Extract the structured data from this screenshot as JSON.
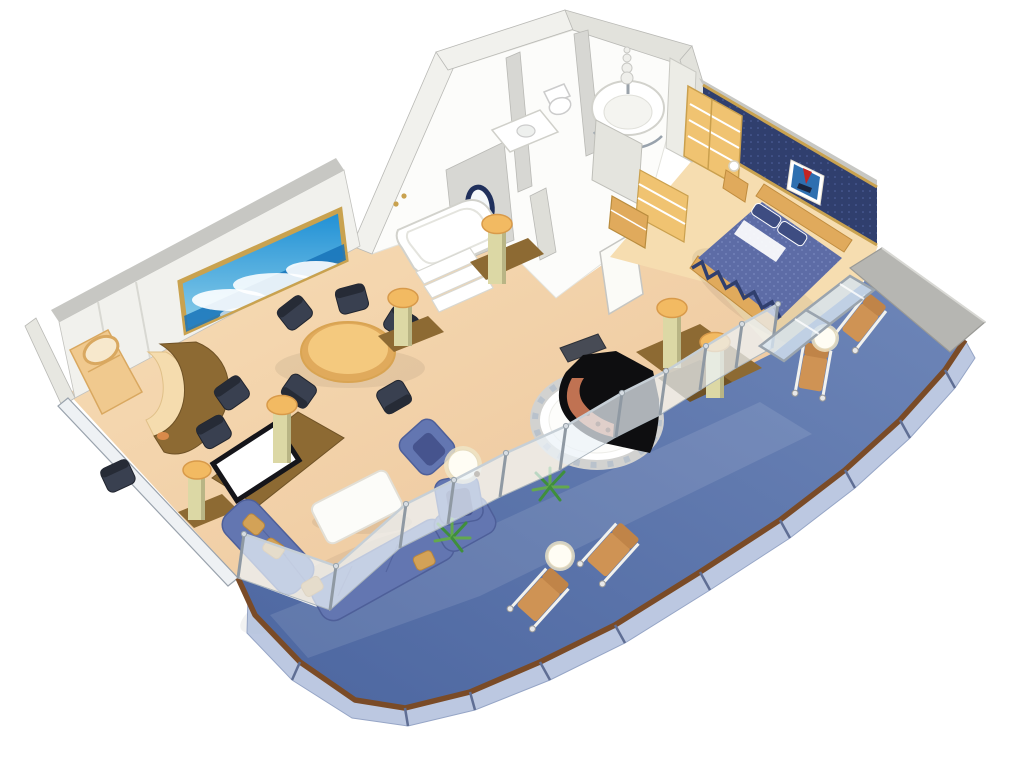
{
  "scene": {
    "type": "cruise-suite-floor-plan",
    "view": "3d-isometric-cutaway",
    "rooms": [
      {
        "name": "living-room",
        "furniture": [
          "wall-mural-seascape",
          "vanity-desk",
          "vanity-mirror",
          "bar-counter",
          "bar-chairs",
          "dining-table",
          "dining-chairs",
          "flat-tv",
          "tv-cabinet",
          "decorative-columns",
          "sectional-sofa",
          "throw-pillows",
          "coffee-table",
          "armchairs",
          "lamp-side-table",
          "potted-plants"
        ]
      },
      {
        "name": "music-area",
        "furniture": [
          "grand-piano",
          "piano-bench",
          "circular-dais"
        ]
      },
      {
        "name": "bathroom",
        "furniture": [
          "whirlpool-tub",
          "tub-steps",
          "circular-shower",
          "shower-statue",
          "toilet",
          "sink-counter",
          "porthole-mirror"
        ]
      },
      {
        "name": "dressing-area",
        "furniture": [
          "wardrobes",
          "shelving",
          "dresser"
        ]
      },
      {
        "name": "bedroom",
        "furniture": [
          "double-bed",
          "pillows",
          "headboard",
          "seascape-artwork",
          "nightstand",
          "table-lamp",
          "balcony-glass-doors"
        ]
      },
      {
        "name": "balcony",
        "furniture": [
          "lounge-chairs",
          "round-side-tables",
          "privacy-divider",
          "glass-railing",
          "wood-handrail"
        ]
      }
    ],
    "colors": {
      "bg": "#ffffff",
      "carpet1": "#f7ddb6",
      "carpet2": "#ecc49a",
      "wallFace": "#f1f1ed",
      "wallTop": "#c7c7c3",
      "wallSide": "#e2e2dc",
      "wallEdge": "#a9a9a5",
      "bathFloor": "#fcfcfa",
      "grayWall": "#d7d7d3",
      "navy": "#303f6e",
      "navyDot": "#5163a0",
      "goldTrim": "#c9a24f",
      "bed": "#5d6ca6",
      "bedDot": "#8494c8",
      "pillowNavy": "#3e4d82",
      "bedroomFloor": "#f6ddb0",
      "woodLight": "#f0c371",
      "woodMid": "#e0aa5c",
      "woodDark": "#8d6a33",
      "woodDeep": "#6f5226",
      "colBody": "#dcd8a5",
      "colShade": "#b9b585",
      "colCap": "#f2ba62",
      "chairDark": "#394050",
      "chairEdge": "#20242e",
      "sofa": "#6376b1",
      "sofaLine": "#4e5f99",
      "cushion": "#d3a257",
      "balcony1": "#6e86b8",
      "balcony2": "#4c66a0",
      "railWood": "#7a4b27",
      "railGlass": "#b5c3de",
      "glass": "#ecf3f8",
      "glassFrame": "#aab4bc",
      "silver": "#8f99a3",
      "muralSky": "#1e8fd5",
      "muralSkyLight": "#8fd0ea",
      "sea": "#1773b8",
      "artSea": "#2e6fb0",
      "artSail": "#c42424",
      "plant": "#3f8f3c",
      "plantLight": "#63a84e",
      "glow": "#fffdf4",
      "glowRim": "#efe6c8",
      "loungeWood": "#cf9354",
      "loungeWoodDark": "#c08448",
      "divider": "#b6b6b2",
      "white": "#ffffff",
      "tubStroke": "#d2d2cc",
      "pianoBlack": "#0e0e10",
      "pianoInner": "#c07252",
      "benchGray": "#474b55",
      "barCream": "#f5dcae",
      "orange": "#d98a4a",
      "tvFrame": "#15151a"
    }
  }
}
